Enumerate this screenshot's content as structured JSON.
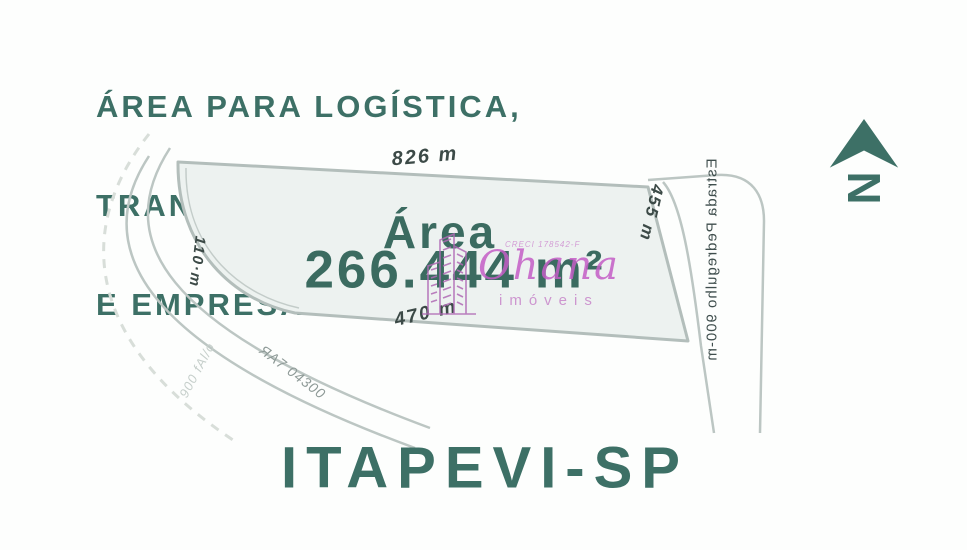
{
  "colors": {
    "teal": "#3d7066",
    "teal_value": "#3b6b60",
    "dim_label": "#3c4a47",
    "road_line": "#b9c3c0",
    "plot_fill": "#edf2f0",
    "plot_border": "#b3bebb",
    "dashed_line": "#d8ded9",
    "magenta": "#c45ec6",
    "magenta_light": "#c887ca"
  },
  "title": {
    "line1": "ÁREA PARA LOGÍSTICA,",
    "line2": "TRANSPORTADORA",
    "line3": "E EMPRESAS"
  },
  "plot": {
    "area_label": "Área",
    "area_value": "266.444 m²",
    "dim_top": "826 m",
    "dim_right": "455 m",
    "dim_bottom": "470 m",
    "dim_left": "110·m"
  },
  "map_labels": {
    "road_right": "Estrada Pedregulho 900-m",
    "road_code": "ЯA7 04300",
    "road_left": "900 fAl/o"
  },
  "compass": {
    "letter": "N"
  },
  "watermark": {
    "brand": "Ohana",
    "subtitle": "imóveis",
    "creci": "CRECI 178542-F"
  },
  "footer": {
    "city": "ITAPEVI-SP"
  }
}
